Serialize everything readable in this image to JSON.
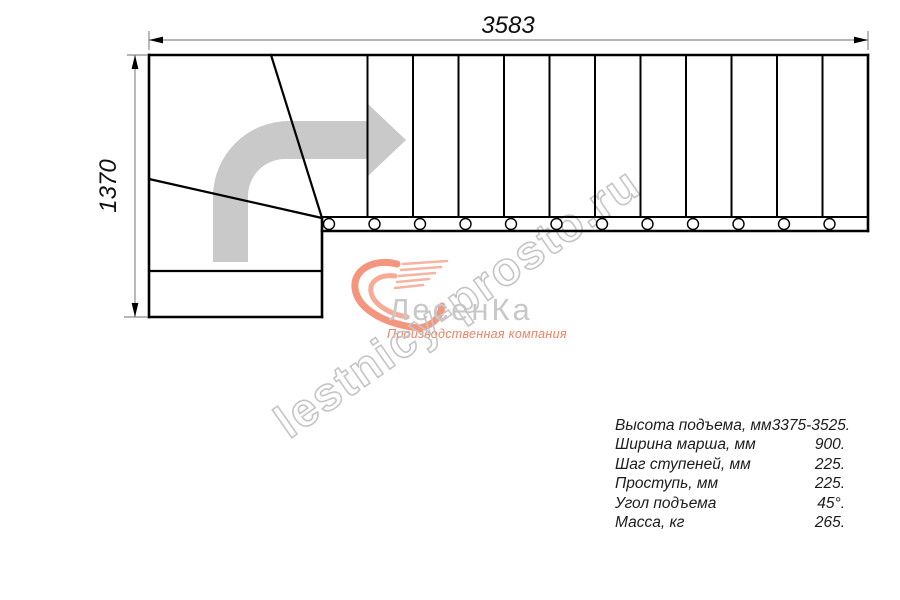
{
  "dimensions": {
    "top": "3583",
    "left": "1370"
  },
  "specs": {
    "rows": [
      {
        "label": "Высота подъема, мм",
        "value": "3375-3525."
      },
      {
        "label": "Ширина марша, мм",
        "value": "900."
      },
      {
        "label": "Шаг ступеней, мм",
        "value": "225."
      },
      {
        "label": "Проступь, мм",
        "value": "225."
      },
      {
        "label": "Угол подъема",
        "value": "45°."
      },
      {
        "label": "Масса, кг",
        "value": "265."
      }
    ]
  },
  "watermark": {
    "text": "lestnicy-prosto.ru"
  },
  "logo": {
    "name": "ЛесенКа",
    "tagline": "Производственная компания"
  },
  "drawing": {
    "straight_steps": 12,
    "tread_lines": 11,
    "balusters": 12,
    "winder_steps": 3,
    "colors": {
      "line": "#000000",
      "dim_line": "#8a8a8a",
      "dim_text": "#111111",
      "arrow": "#c9c9c9",
      "watermark": "#c5c5c5",
      "logo_text": "#c8c8c8",
      "logo_accent": "#f4967e",
      "spec_text": "#1b1b1b"
    }
  }
}
